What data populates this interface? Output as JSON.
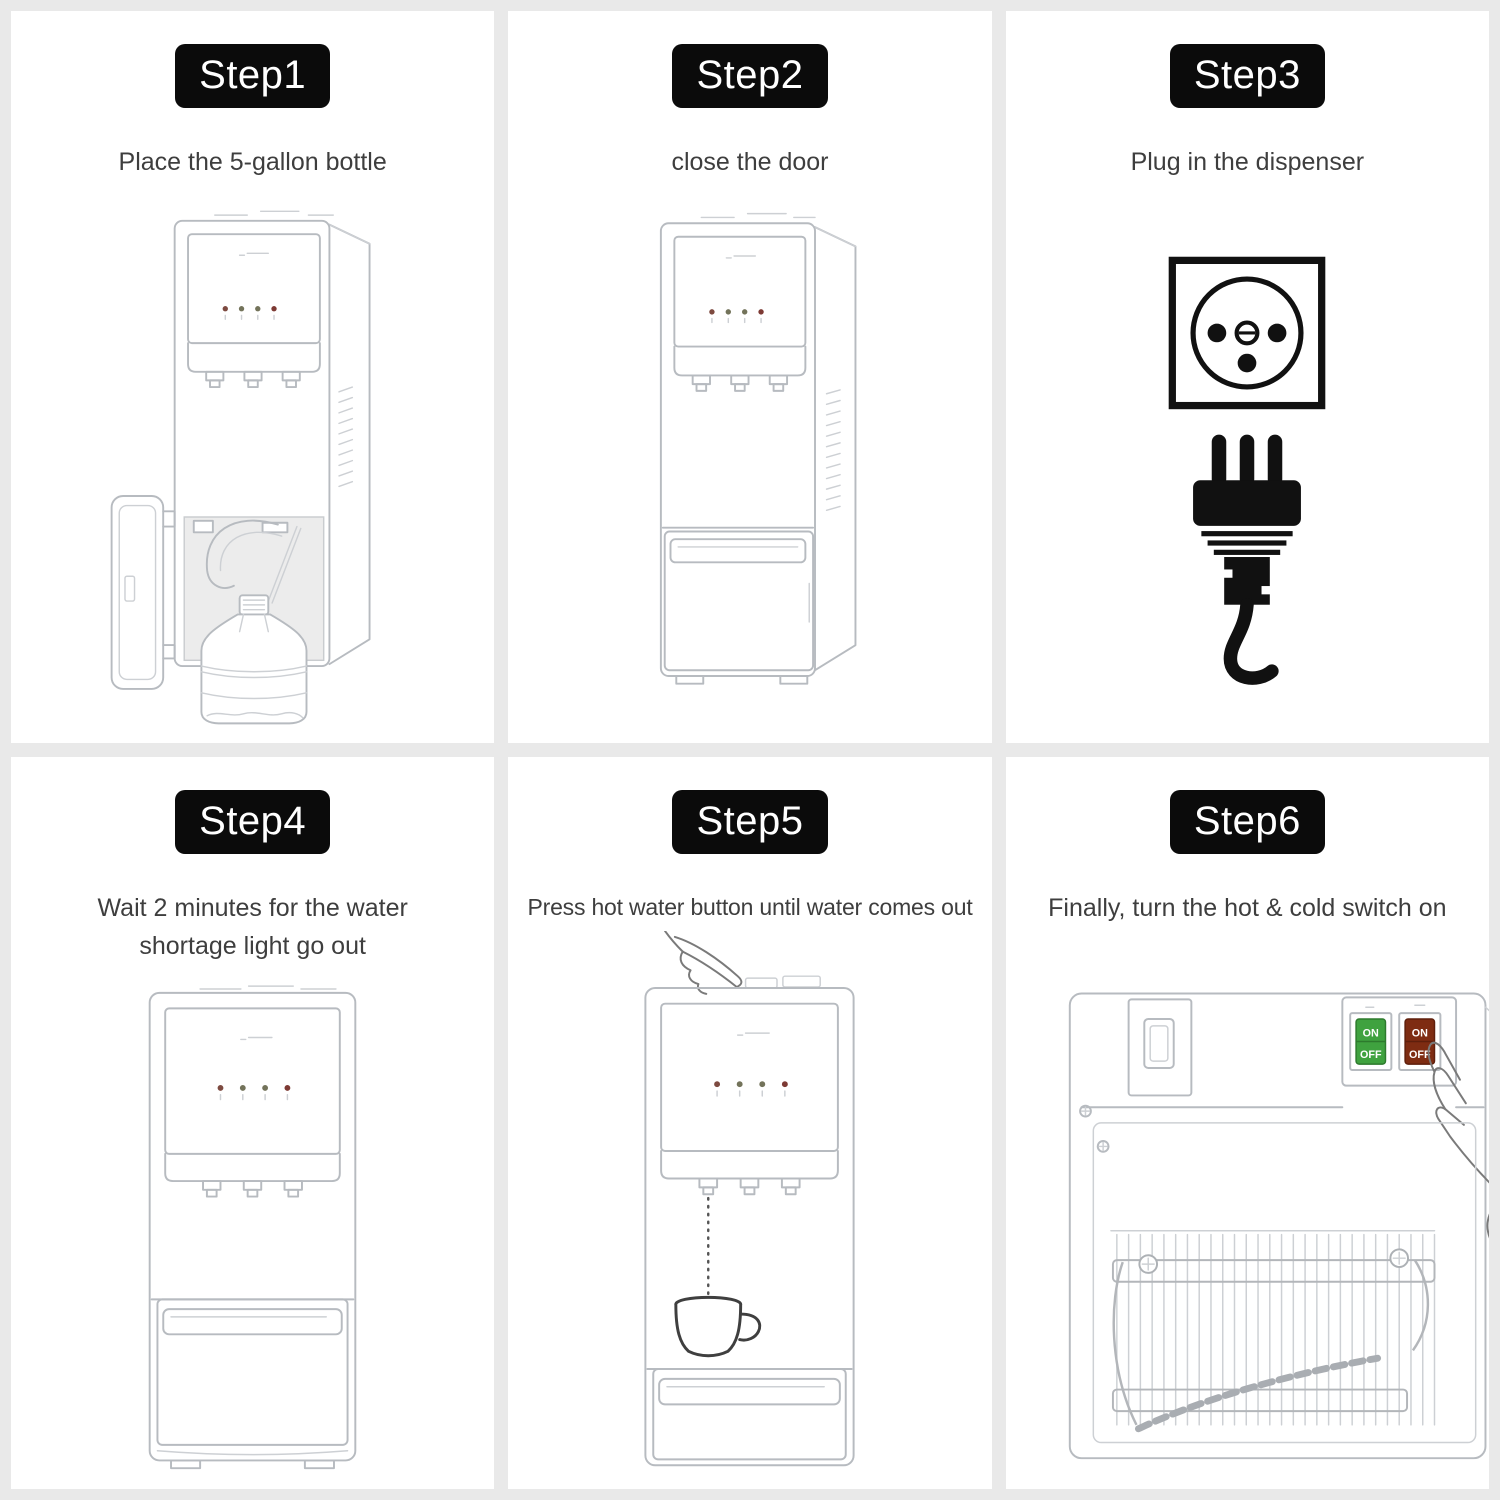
{
  "page": {
    "background_color": "#e9e9e9",
    "panel_color": "#ffffff",
    "badge_background": "#0b0b0b",
    "badge_text_color": "#ffffff",
    "caption_color": "#3e3e3e"
  },
  "steps": [
    {
      "badge": "Step1",
      "caption": "Place the 5-gallon bottle",
      "figure": "water-dispenser-open-door-with-5-gallon-bottle"
    },
    {
      "badge": "Step2",
      "caption": "close the door",
      "figure": "water-dispenser-door-closed"
    },
    {
      "badge": "Step3",
      "caption": "Plug in the dispenser",
      "figure": "power-socket-and-plug"
    },
    {
      "badge": "Step4",
      "caption": "Wait 2 minutes for the water shortage light go out",
      "figure": "water-dispenser-front-indicator-lights"
    },
    {
      "badge": "Step5",
      "caption": "Press hot water button until water comes out",
      "figure": "hand-pressing-hot-water-button-water-into-cup"
    },
    {
      "badge": "Step6",
      "caption": "Finally, turn the hot & cold switch on",
      "figure": "water-dispenser-back-power-switches",
      "switches": [
        {
          "on_label": "ON",
          "off_label": "OFF",
          "color": "#3fa23f"
        },
        {
          "on_label": "ON",
          "off_label": "OFF",
          "color": "#7e2c12"
        }
      ]
    }
  ]
}
